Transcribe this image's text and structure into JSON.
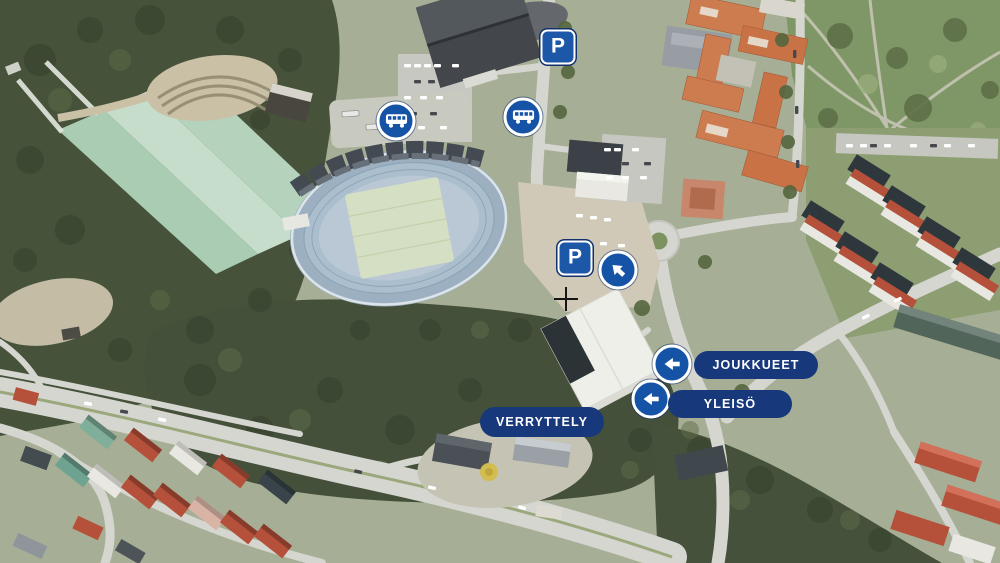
{
  "overlay": {
    "parking_sign": {
      "letter": "P",
      "count": 2
    },
    "bus_stop_signs": {
      "count": 2
    },
    "direction_arrows": {
      "count": 3,
      "directions": [
        "up-left",
        "left",
        "left"
      ]
    },
    "pills": [
      {
        "id": "joukkueet",
        "text": "JOUKKUEET"
      },
      {
        "id": "yleiso",
        "text": "YLEISÖ"
      },
      {
        "id": "verryttely",
        "text": "VERRYTTELY"
      }
    ]
  },
  "colors": {
    "pill_navy": "#17397b",
    "sign_blue": "#1553a7",
    "parking_sign_blue": "#1d57a8",
    "sign_border_white": "#ffffff",
    "crosshair_black": "#151515"
  },
  "icons": {
    "parking": "parking-sign-icon",
    "bus": "bus-sign-icon",
    "arrow_left": "arrow-left-icon",
    "arrow_up_left": "arrow-up-left-icon",
    "crosshair": "crosshair-icon"
  }
}
